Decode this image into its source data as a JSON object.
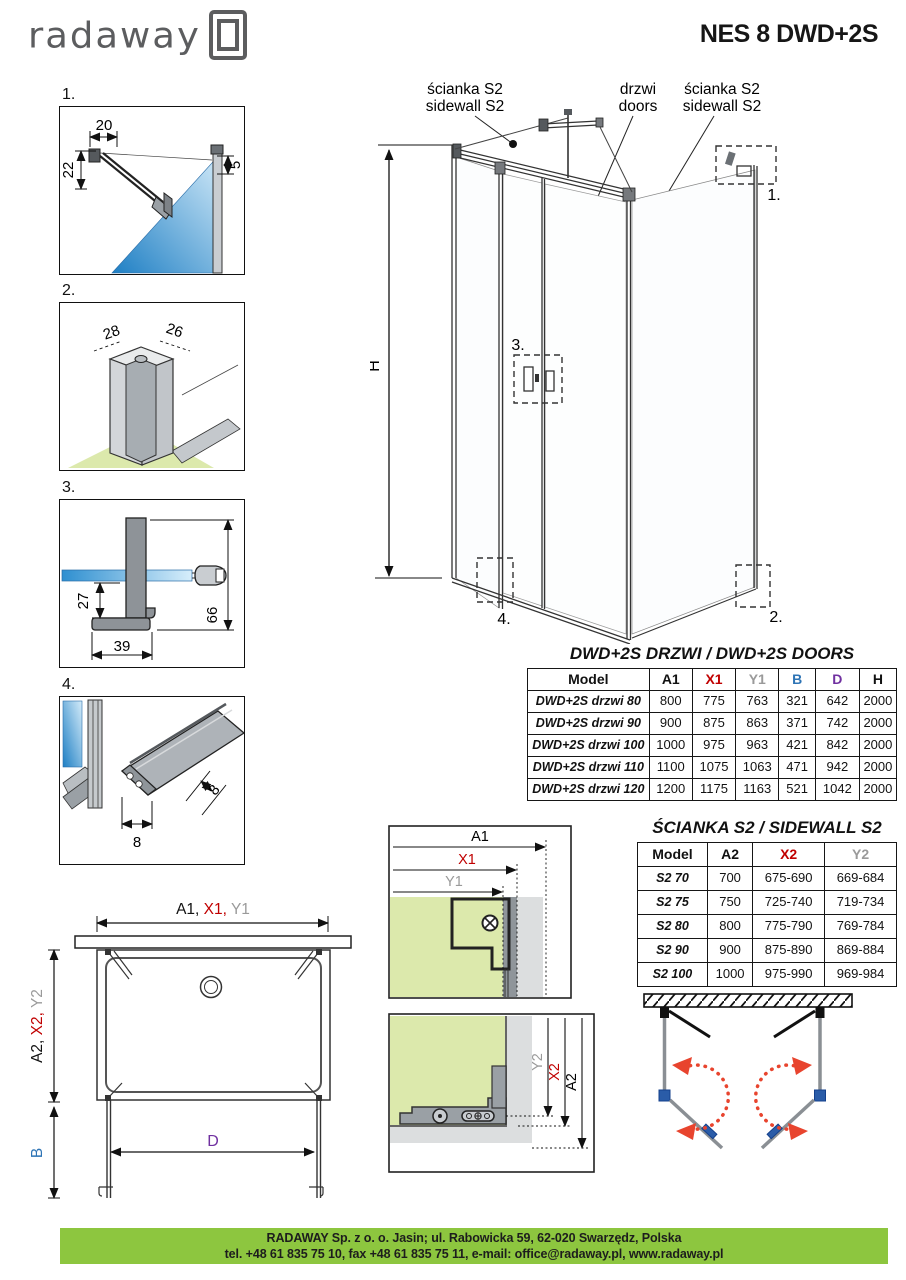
{
  "header": {
    "brand": "radaway",
    "title": "NES 8 DWD+2S"
  },
  "colors": {
    "red": "#c00000",
    "gray": "#9a9a9a",
    "blue": "#2e74b5",
    "purple": "#7030a0",
    "black": "#111111",
    "footer_green": "#8dc63f",
    "glass_blue": "#2e8fd0",
    "floor_green": "#dce9ac"
  },
  "details": {
    "d1": {
      "num": "1.",
      "dim_top": "20",
      "dim_left": "22",
      "dim_right": "5"
    },
    "d2": {
      "num": "2.",
      "dim_left": "28",
      "dim_right": "26"
    },
    "d3": {
      "num": "3.",
      "dim_left": "27",
      "dim_bottom": "39",
      "dim_right": "66"
    },
    "d4": {
      "num": "4.",
      "dim_side": "8",
      "dim_bottom": "8"
    }
  },
  "main_diagram": {
    "label_sidewall_left_1": "ścianka S2",
    "label_sidewall_left_2": "sidewall S2",
    "label_doors_1": "drzwi",
    "label_doors_2": "doors",
    "label_sidewall_right_1": "ścianka S2",
    "label_sidewall_right_2": "sidewall S2",
    "height_label": "H",
    "callout_1": "1.",
    "callout_2": "2.",
    "callout_3": "3.",
    "callout_4": "4."
  },
  "doors_table": {
    "title": "DWD+2S DRZWI / DWD+2S DOORS",
    "columns": [
      {
        "label": "Model",
        "color": "black"
      },
      {
        "label": "A1",
        "color": "black"
      },
      {
        "label": "X1",
        "color": "red"
      },
      {
        "label": "Y1",
        "color": "gray"
      },
      {
        "label": "B",
        "color": "blue"
      },
      {
        "label": "D",
        "color": "purple"
      },
      {
        "label": "H",
        "color": "black"
      }
    ],
    "rows": [
      [
        "DWD+2S drzwi 80",
        "800",
        "775",
        "763",
        "321",
        "642",
        "2000"
      ],
      [
        "DWD+2S drzwi 90",
        "900",
        "875",
        "863",
        "371",
        "742",
        "2000"
      ],
      [
        "DWD+2S drzwi 100",
        "1000",
        "975",
        "963",
        "421",
        "842",
        "2000"
      ],
      [
        "DWD+2S drzwi 110",
        "1100",
        "1075",
        "1063",
        "471",
        "942",
        "2000"
      ],
      [
        "DWD+2S drzwi 120",
        "1200",
        "1175",
        "1163",
        "521",
        "1042",
        "2000"
      ]
    ]
  },
  "sidewall_table": {
    "title": "ŚCIANKA S2 / SIDEWALL S2",
    "columns": [
      {
        "label": "Model",
        "color": "black"
      },
      {
        "label": "A2",
        "color": "black"
      },
      {
        "label": "X2",
        "color": "red"
      },
      {
        "label": "Y2",
        "color": "gray"
      }
    ],
    "rows": [
      [
        "S2 70",
        "700",
        "675-690",
        "669-684"
      ],
      [
        "S2 75",
        "750",
        "725-740",
        "719-734"
      ],
      [
        "S2 80",
        "800",
        "775-790",
        "769-784"
      ],
      [
        "S2 90",
        "900",
        "875-890",
        "869-884"
      ],
      [
        "S2 100",
        "1000",
        "975-990",
        "969-984"
      ]
    ]
  },
  "plan": {
    "dim_top_a1": "A1,",
    "dim_top_x1": " X1,",
    "dim_top_y1": " Y1",
    "dim_left_a2": "A2, ",
    "dim_left_x2": "X2, ",
    "dim_left_y2": "Y2",
    "dim_b": "B",
    "dim_d": "D"
  },
  "detail_a1": {
    "a1": "A1",
    "x1": "X1",
    "y1": "Y1"
  },
  "detail_a2": {
    "y2": "Y2",
    "x2": "X2",
    "a2": "A2"
  },
  "footer": {
    "line1": "RADAWAY Sp. z o. o. Jasin; ul. Rabowicka 59, 62-020 Swarzędz, Polska",
    "line2": "tel. +48 61 835 75 10, fax +48 61 835 75 11, e-mail: office@radaway.pl, www.radaway.pl"
  }
}
